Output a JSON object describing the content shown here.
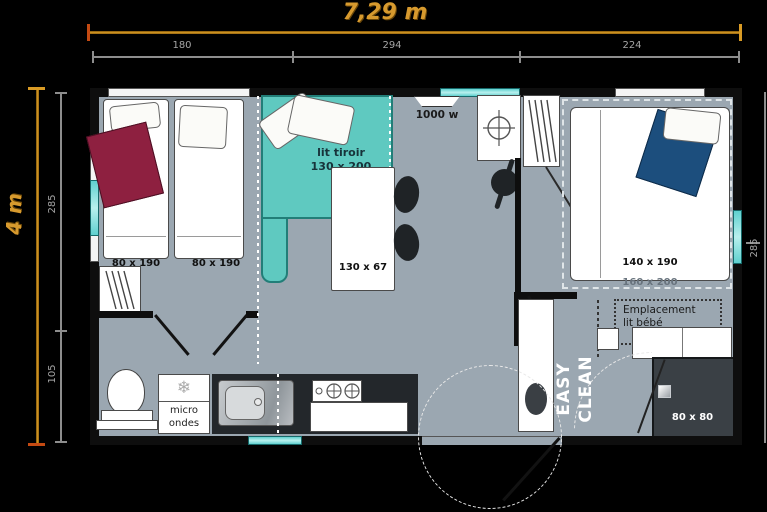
{
  "dimensions": {
    "width_total": "7,29 m",
    "height_total": "4 m",
    "top": [
      "180",
      "294",
      "224"
    ],
    "left": [
      "285",
      "105"
    ],
    "right": [
      "285"
    ]
  },
  "labels": {
    "bed_left_1": "80 x 190",
    "bed_left_2": "80 x 190",
    "sofa_1": "lit tiroir",
    "sofa_2": "130 x 200",
    "heater": "1000 w",
    "table": "130 x 67",
    "bed_master": "140 x 190",
    "bed_master_zone": "160 x 200",
    "baby_1": "Emplacement",
    "baby_2": "lit bébé",
    "shower": "80 x 80",
    "brand_1": "EASY",
    "brand_2": "CLEAN",
    "appliance_1": "micro",
    "appliance_2": "ondes"
  },
  "colors": {
    "background": "#000000",
    "accent_orange": "#D79A2E",
    "dimension_gray": "#9a9a9a",
    "wall": "#0e0e0e",
    "floor": "#9BA7B1",
    "sofa_teal": "#5FC9C0",
    "window_teal": "#8FE3E0",
    "blanket_red": "#8E2040",
    "blanket_blue": "#1C4E7D",
    "counter_dark": "#23272B"
  }
}
